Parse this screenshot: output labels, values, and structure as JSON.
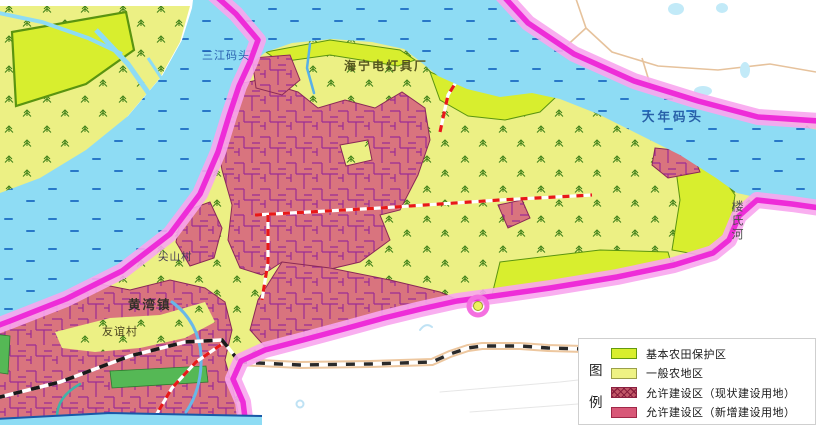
{
  "map": {
    "labels": {
      "dock_nw": "三江码头",
      "factory": "海宁电灯具厂",
      "dock_ne": "大年码头",
      "river_east": "楼氏河",
      "town": "黄湾镇",
      "village_w": "尖山村",
      "village_sw": "友谊村"
    },
    "colors": {
      "river": "#8edcf4",
      "river_marks": "#2878c8",
      "farmland_general": "#ecf084",
      "farmland_protected": "#d8ee2e",
      "farmland_protected_border": "#5a9410",
      "built_existing": "#d9747e",
      "built_parcel_lines": "#9c2c94",
      "built_new": "#d85878",
      "greenbelt": "#55b855",
      "boundary": "#ee2cd8",
      "boundary_glow": "#f8a6ee",
      "planned_road_dash": "#e81818",
      "water_label_text": "#2860a8"
    }
  },
  "legend": {
    "title_chars": [
      "图",
      "例"
    ],
    "items": [
      {
        "label": "基本农田保护区",
        "swatch": "#d8ee2e",
        "border": "#639a0e",
        "pattern": "solid"
      },
      {
        "label": "一般农地区",
        "swatch": "#eef284",
        "border": "#9aa04a",
        "pattern": "solid"
      },
      {
        "label": "允许建设区（现状建设用地）",
        "swatch": "#c05868",
        "border": "#8a2040",
        "pattern": "crosshatch"
      },
      {
        "label": "允许建设区（新增建设用地）",
        "swatch": "#d85878",
        "border": "#a02848",
        "pattern": "solid"
      }
    ]
  }
}
